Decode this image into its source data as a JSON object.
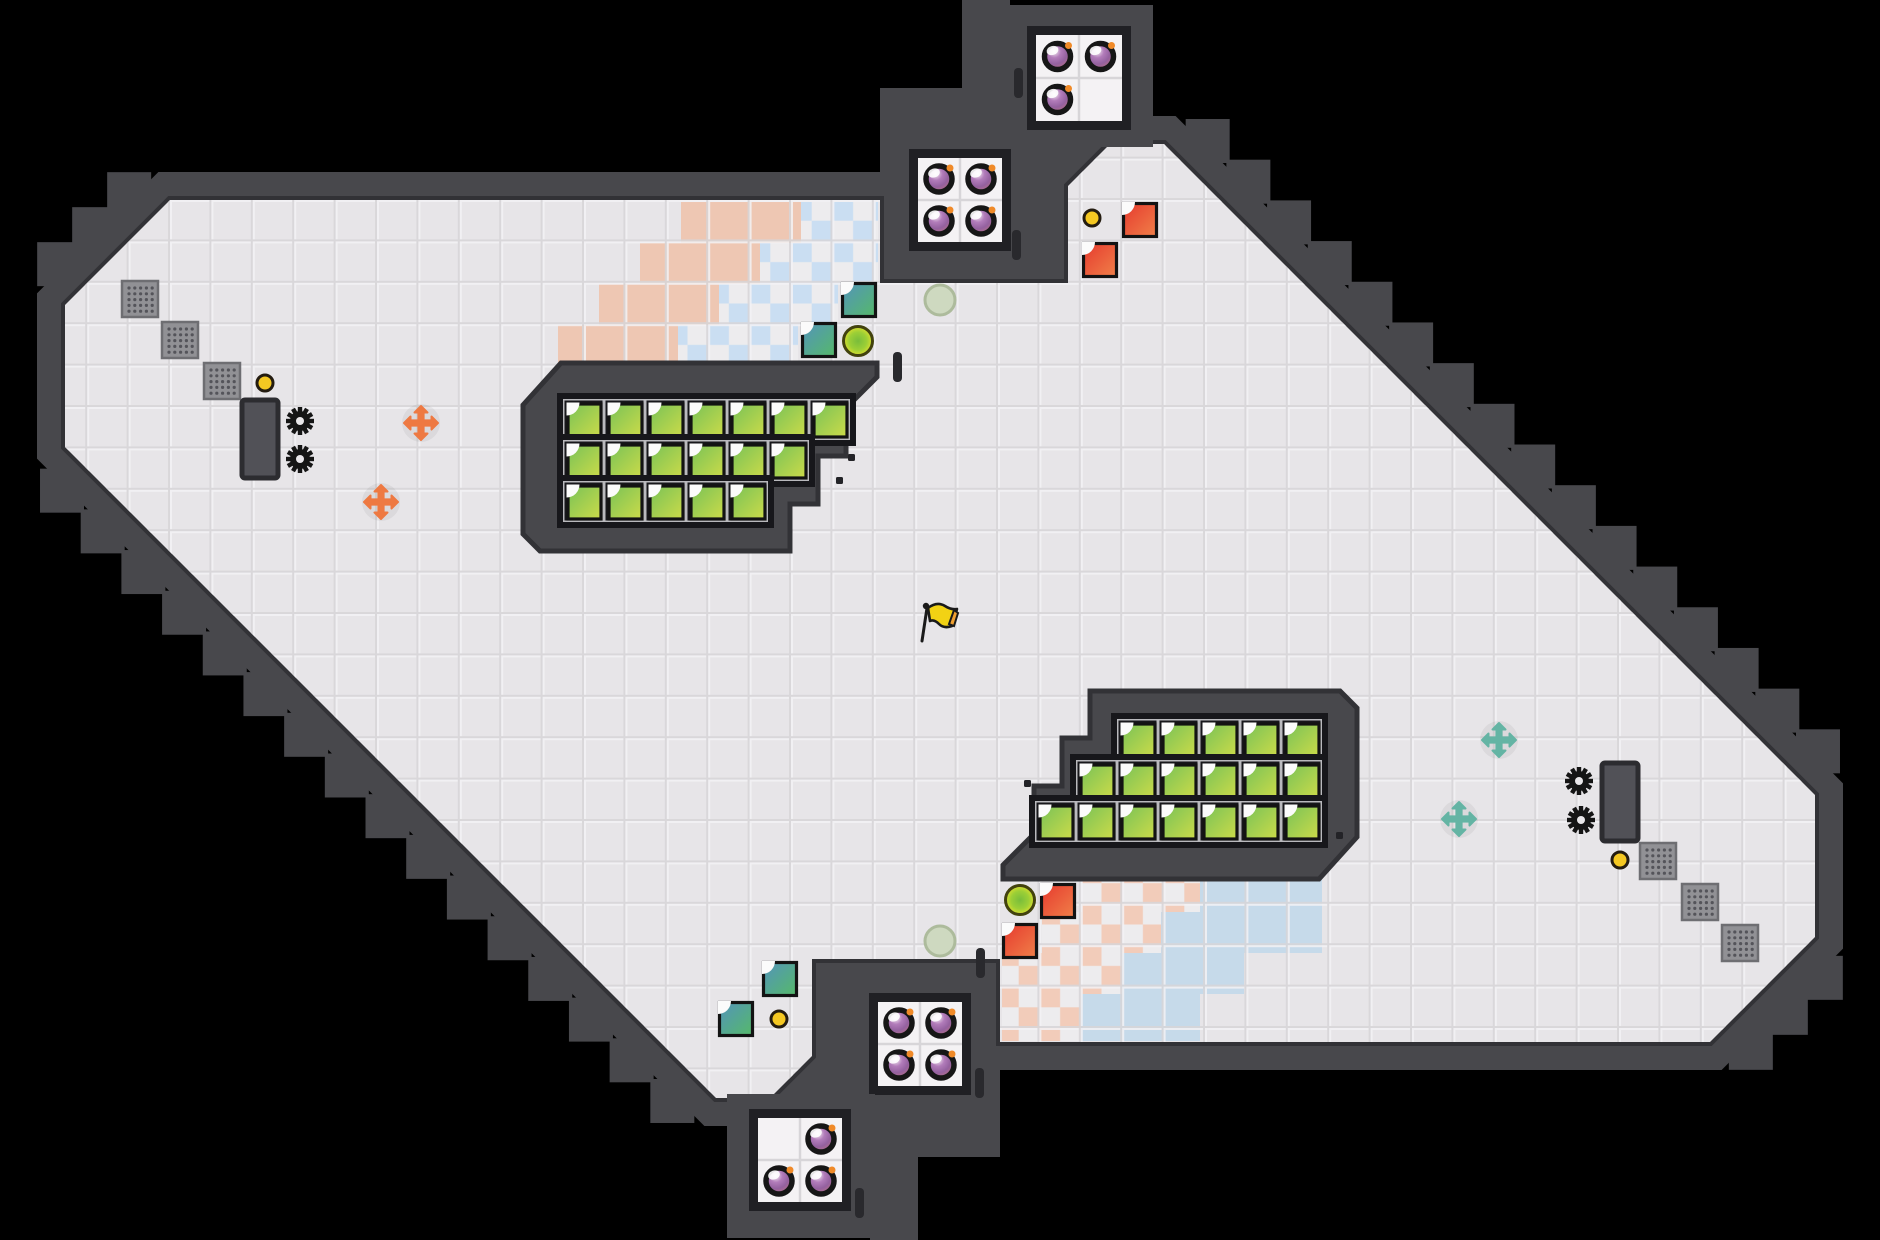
{
  "scene": "level-overview-map",
  "canvas": {
    "width": 1880,
    "height": 1240,
    "background": "#000000"
  },
  "colors": {
    "wall": "#48484c",
    "wall_edge": "#323236",
    "floor": "#e7e5e8",
    "grid_light": "#f3f2f5",
    "grid_dark": "#d7d5d8",
    "room_tile": "#f4f2f4",
    "room_frame": "#202024",
    "cell_backdrop": "#17171b",
    "cell_frame": "#b9b9bd",
    "salmon": "#eec7b3",
    "blue_solid": "#c6daea",
    "checker_pink": "#f2ccba",
    "checker_blue": "#cadef2",
    "checker_white": "#edecee",
    "green_tile_a": "#79c257",
    "green_tile_b": "#ccdb49",
    "teal_tile_a": "#5494bb",
    "teal_tile_b": "#55b969",
    "red_tile_a": "#e63a2e",
    "red_tile_b": "#f08049",
    "tile_border": "#131313",
    "notch": "#fbfbfb",
    "bomb_ring": "#161616",
    "bomb_fuse": "#f08a28",
    "coin": "#f5c822",
    "coin_ring": "#241c10",
    "gear": "#151515",
    "gear_hole": "#e9e7ea",
    "door_fill": "#515157",
    "door_edge": "#2c2c30",
    "grate_fill": "#919195",
    "grate_edge": "#6e6e72",
    "grate_dot": "#54545a",
    "arrow_orange": "#ee7942",
    "arrow_teal": "#64b4a4",
    "button_edge": "#42420e",
    "plate_fill": "#ced9c0",
    "plate_edge": "#adbb9c",
    "flag_yellow": "#f2d214",
    "flag_tip": "#f0a030",
    "flag_ink": "#1a1a1a",
    "wall_notch": "#29292d"
  },
  "map": {
    "tile_pitch": 41.4,
    "floor_outline": [
      {
        "x": 170,
        "y": 200,
        "seg": "L"
      },
      {
        "x": 880,
        "y": 200,
        "seg": "L"
      },
      {
        "x": 880,
        "y": 283,
        "seg": "L"
      },
      {
        "x": 1068,
        "y": 283,
        "seg": "L"
      },
      {
        "x": 1068,
        "y": 186,
        "seg": "D"
      },
      {
        "x": 1110,
        "y": 144,
        "seg": "L"
      },
      {
        "x": 1164,
        "y": 144,
        "seg": "D"
      },
      {
        "x": 1815,
        "y": 795,
        "seg": "L"
      },
      {
        "x": 1815,
        "y": 937,
        "seg": "D"
      },
      {
        "x": 1710,
        "y": 1042,
        "seg": "L"
      },
      {
        "x": 1000,
        "y": 1042,
        "seg": "L"
      },
      {
        "x": 1000,
        "y": 959,
        "seg": "L"
      },
      {
        "x": 812,
        "y": 959,
        "seg": "L"
      },
      {
        "x": 812,
        "y": 1056,
        "seg": "D"
      },
      {
        "x": 770,
        "y": 1098,
        "seg": "L"
      },
      {
        "x": 716,
        "y": 1098,
        "seg": "D"
      },
      {
        "x": 65,
        "y": 447,
        "seg": "L"
      },
      {
        "x": 65,
        "y": 305,
        "seg": "D"
      }
    ],
    "wall_band": 56,
    "tooth_size": 44,
    "tooth_spacing": 58.5,
    "tooth_offset": 33,
    "masses": [
      [
        880,
        88,
        188,
        195
      ],
      [
        812,
        959,
        188,
        198
      ]
    ],
    "pillars": [
      [
        962,
        0,
        48,
        92
      ],
      [
        870,
        1150,
        48,
        92
      ]
    ],
    "pocket_walls": [
      [
        877,
        283,
        35,
        86
      ],
      [
        968,
        873,
        35,
        86
      ]
    ],
    "wall_notches": [
      [
        1014,
        68
      ],
      [
        1012,
        230
      ],
      [
        976,
        948
      ],
      [
        975,
        1068
      ],
      [
        855,
        1188
      ],
      [
        893,
        352
      ]
    ],
    "wall_dots": [
      [
        848,
        454
      ],
      [
        836,
        477
      ],
      [
        1024,
        780
      ],
      [
        1336,
        832
      ]
    ],
    "terrain_top_rows": [
      {
        "y": 202,
        "h": 41,
        "salmon": [
          681,
          801
        ],
        "checker": [
          801,
          878
        ],
        "blue": null
      },
      {
        "y": 243,
        "h": 41,
        "salmon": [
          640,
          760
        ],
        "checker": [
          760,
          878
        ],
        "blue": null
      },
      {
        "y": 284,
        "h": 41,
        "salmon": [
          599,
          719
        ],
        "checker": [
          719,
          838
        ],
        "blue": null
      },
      {
        "y": 325,
        "h": 40,
        "salmon": [
          558,
          678
        ],
        "checker": [
          678,
          798
        ],
        "blue": null
      }
    ],
    "terrain_bottom_rows": [
      {
        "y": 871,
        "h": 41,
        "salmon": null,
        "checker": [
          1082,
          1200
        ],
        "blue": [
          1200,
          1322
        ]
      },
      {
        "y": 912,
        "h": 41,
        "salmon": null,
        "checker": [
          1042,
          1161
        ],
        "blue": [
          1161,
          1322
        ]
      },
      {
        "y": 953,
        "h": 41,
        "salmon": null,
        "checker": [
          1002,
          1122
        ],
        "blue": [
          1122,
          1244
        ]
      },
      {
        "y": 994,
        "h": 47,
        "salmon": null,
        "checker": [
          1002,
          1081
        ],
        "blue": [
          1081,
          1200
        ]
      }
    ],
    "enclaves": [
      {
        "outline": [
          [
            523,
            405
          ],
          [
            561,
            363
          ],
          [
            877,
            363
          ],
          [
            877,
            377
          ],
          [
            846,
            408
          ],
          [
            846,
            456
          ],
          [
            818,
            456
          ],
          [
            818,
            504
          ],
          [
            790,
            504
          ],
          [
            790,
            551
          ],
          [
            540,
            551
          ],
          [
            523,
            534
          ]
        ],
        "grid": {
          "align": "left",
          "x": 563,
          "y": 399,
          "rows": [
            7,
            6,
            5
          ],
          "pitch": 41,
          "tile": 34
        }
      },
      {
        "outline": [
          [
            1357,
            837
          ],
          [
            1319,
            879
          ],
          [
            1003,
            879
          ],
          [
            1003,
            865
          ],
          [
            1034,
            834
          ],
          [
            1034,
            786
          ],
          [
            1062,
            786
          ],
          [
            1062,
            738
          ],
          [
            1090,
            738
          ],
          [
            1090,
            691
          ],
          [
            1340,
            691
          ],
          [
            1357,
            708
          ]
        ],
        "grid": {
          "align": "right",
          "x": 1322,
          "y": 719,
          "rows": [
            5,
            6,
            7
          ],
          "pitch": 41,
          "tile": 34
        }
      }
    ],
    "bomb_rooms": [
      {
        "ix": 1036,
        "iy": 35,
        "cell": 43,
        "cols": 2,
        "rows": 2,
        "bombs": [
          [
            0,
            0
          ],
          [
            1,
            0
          ],
          [
            0,
            1
          ]
        ],
        "block": [
          1005,
          5,
          148,
          142
        ]
      },
      {
        "ix": 918,
        "iy": 158,
        "cell": 42,
        "cols": 2,
        "rows": 2,
        "bombs": [
          [
            0,
            0
          ],
          [
            1,
            0
          ],
          [
            0,
            1
          ],
          [
            1,
            1
          ]
        ],
        "block": null
      },
      {
        "ix": 878,
        "iy": 1002,
        "cell": 42,
        "cols": 2,
        "rows": 2,
        "bombs": [
          [
            0,
            0
          ],
          [
            1,
            0
          ],
          [
            0,
            1
          ],
          [
            1,
            1
          ]
        ],
        "block": null
      },
      {
        "ix": 758,
        "iy": 1118,
        "cell": 42,
        "cols": 2,
        "rows": 2,
        "bombs": [
          [
            1,
            0
          ],
          [
            0,
            1
          ],
          [
            1,
            1
          ]
        ],
        "block": [
          727,
          1094,
          148,
          144
        ]
      }
    ]
  },
  "items": {
    "grates": [
      [
        122,
        281
      ],
      [
        162,
        322
      ],
      [
        204,
        363
      ],
      [
        1640,
        843
      ],
      [
        1682,
        884
      ],
      [
        1722,
        925
      ]
    ],
    "coins": [
      [
        265,
        383
      ],
      [
        1092,
        218
      ],
      [
        779,
        1019
      ],
      [
        1620,
        860
      ]
    ],
    "doors": [
      [
        242,
        400
      ],
      [
        1602,
        763
      ]
    ],
    "gears": [
      [
        300,
        421
      ],
      [
        300,
        459
      ],
      [
        1579,
        781
      ],
      [
        1581,
        820
      ]
    ],
    "arrows_orange": [
      [
        421,
        423
      ],
      [
        381,
        502
      ]
    ],
    "arrows_teal": [
      [
        1499,
        740
      ],
      [
        1459,
        819
      ]
    ],
    "teal_tiles": [
      [
        841,
        282
      ],
      [
        801,
        322
      ],
      [
        762,
        961
      ],
      [
        718,
        1001
      ]
    ],
    "red_tiles": [
      [
        1122,
        202
      ],
      [
        1082,
        242
      ],
      [
        1040,
        883
      ],
      [
        1002,
        923
      ]
    ],
    "buttons": [
      [
        858,
        341
      ],
      [
        1020,
        900
      ]
    ],
    "plates": [
      [
        940,
        300
      ],
      [
        940,
        941
      ]
    ],
    "flag": {
      "x": 921,
      "y": 600
    }
  }
}
